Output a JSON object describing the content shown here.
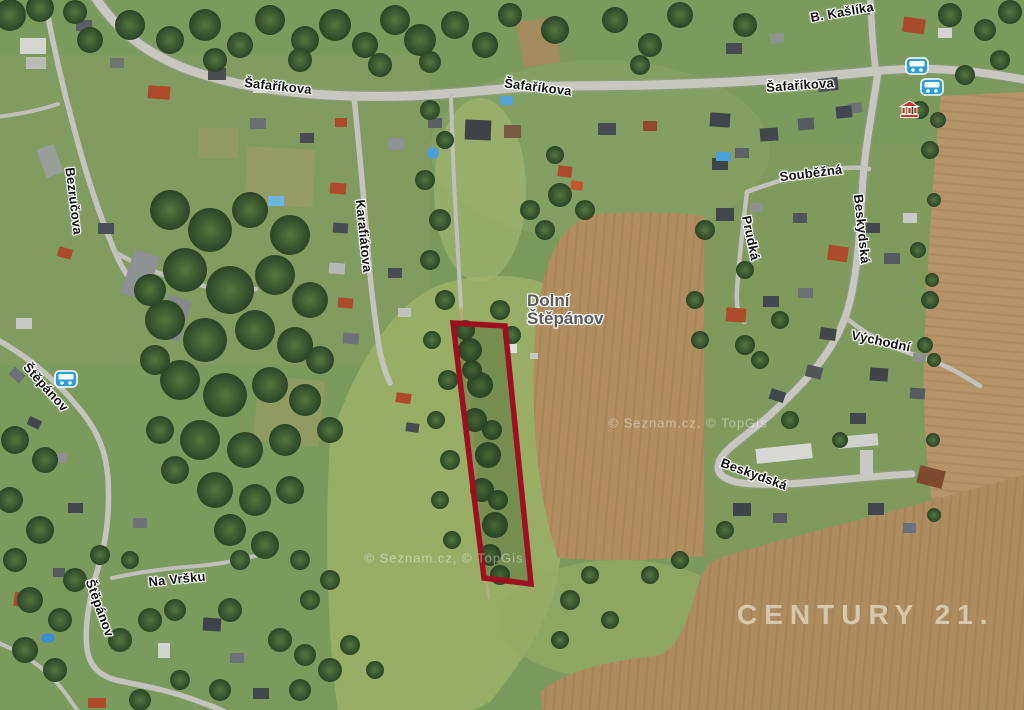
{
  "labels": {
    "safarikova_w": "Šafaříkova",
    "safarikova_c": "Šafaříkova",
    "safarikova_e": "Šafaříkova",
    "b_kaslika": "B. Kašlíka",
    "bezrucova": "Bezručova",
    "karafiatova": "Karafiátova",
    "stepanov_w": "Štěpánov",
    "stepanov_s": "Štěpánov",
    "na_vrsku": "Na Vršku",
    "soubezna": "Souběžná",
    "prudka": "Prudká",
    "beskydska_n": "Beskydská",
    "beskydska_s": "Beskydská",
    "vychodni": "Východní",
    "place": {
      "line1": "Dolní",
      "line2": "Štěpánov"
    }
  },
  "watermarks": {
    "brand": "CENTURY 21.",
    "attribution": "© Seznam.cz, © TopGis"
  },
  "parcel": {
    "points": "453,323 505,326 531,584 484,578",
    "outline_color": "#9e0f1f"
  },
  "icons": {
    "bus_stop": "bus-stop",
    "landmark": "landmark-building"
  },
  "colors": {
    "grass_green": "#7d9a5e",
    "meadow_light": "#9cb269",
    "forest_green": "#2f4a28",
    "field_brown": "#b28d61",
    "road_gray": "#c7c7c0",
    "bus_icon_blue": "#2b9fd9",
    "landmark_red": "#c0392b",
    "roof_red": "#ad4a2c",
    "roof_dark": "#42474b"
  }
}
